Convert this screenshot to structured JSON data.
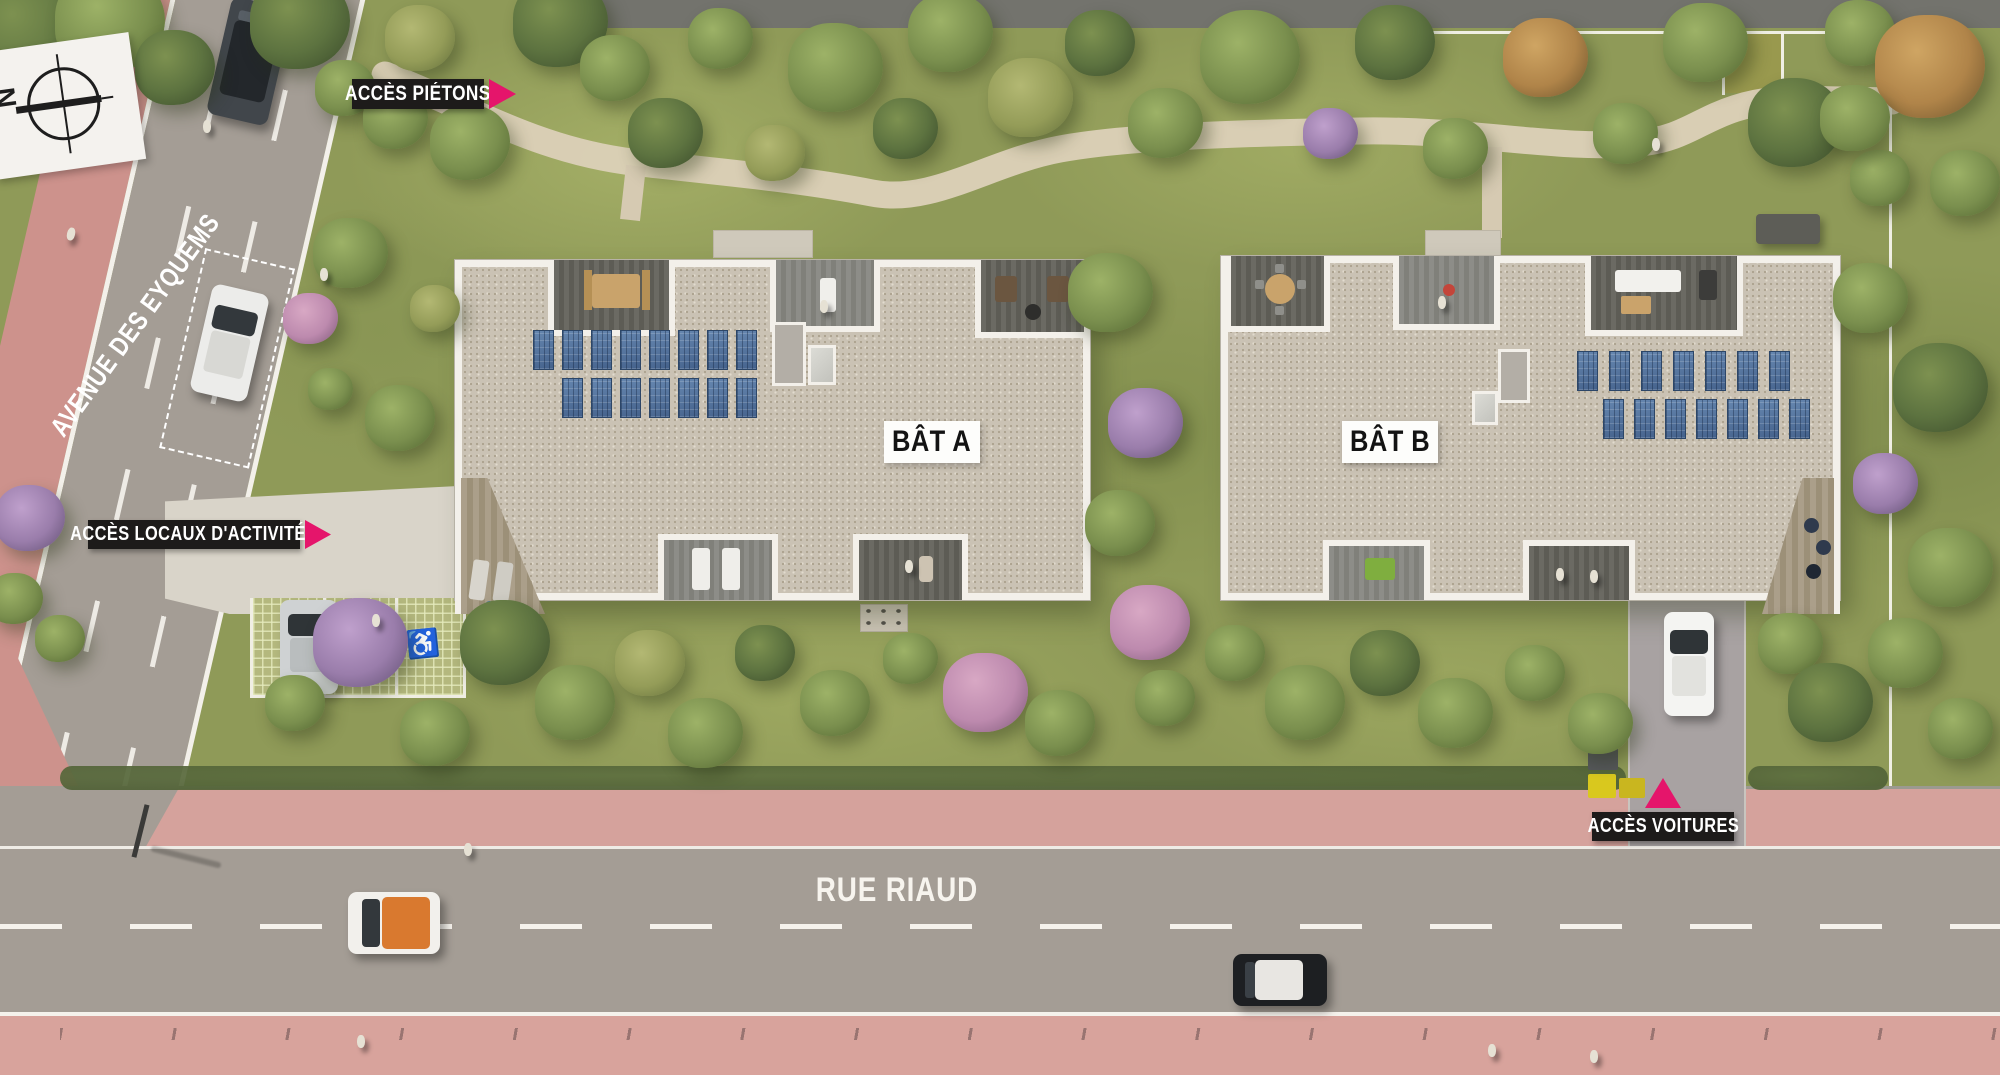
{
  "plan": {
    "compass": {
      "north": "N"
    },
    "streets": {
      "avenue": "AVENUE DES EYQUEMS",
      "rue": "RUE RIAUD"
    },
    "buildings": {
      "a": {
        "label": "BÂT A"
      },
      "b": {
        "label": "BÂT B"
      }
    },
    "access": {
      "pedestrians": "ACCÈS PIÉTONS",
      "locaux": "ACCÈS LOCAUX D'ACTIVITÉS",
      "voitures": "ACCÈS VOITURES"
    },
    "symbols": {
      "disabled_parking": "♿"
    },
    "colors": {
      "accent_pink": "#e5156b",
      "label_background": "#1d1b1a",
      "label_text": "#ffffff",
      "building_label_background": "#fdfdfb",
      "road_grey": "#a49d95",
      "sidewalk_pink": "#d5a29c",
      "bike_path_pink": "#cd928c",
      "grass_green": "#8f9a58",
      "roof_gravel": "#cac2b4",
      "solar_panel_blue": "#53719b"
    }
  }
}
